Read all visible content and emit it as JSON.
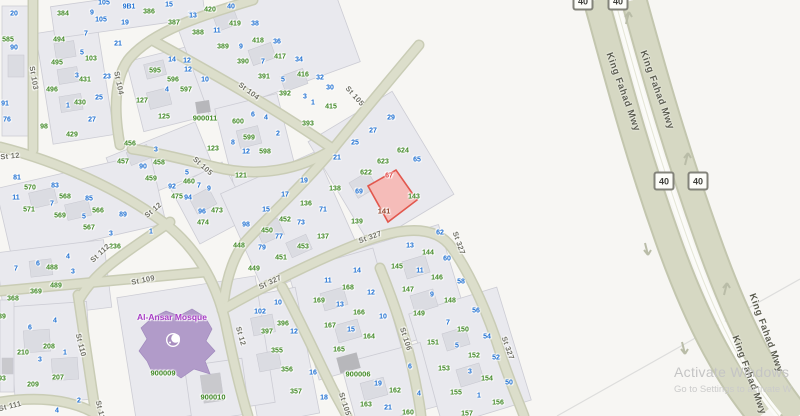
{
  "map": {
    "colors": {
      "lot_number_blue": "#1e6fd1",
      "parcel_number_green": "#3f8724",
      "selected_unit_red": "#e04040",
      "selected_parcel_text": "#8f4026",
      "selected_parcel_fill": "#f5b9b5",
      "selected_parcel_stroke": "#e2574d",
      "road_fill": "#dcdecb",
      "mosque_fill": "#b19bc9",
      "mosque_label": "#a63bc4"
    },
    "selected_parcel": {
      "number": "141",
      "unit_number": "67"
    },
    "mosque": {
      "label": "Al-Ansar Mosque",
      "x": 172,
      "y": 317,
      "parcel_id": "900009"
    },
    "street_labels": [
      {
        "t": "St 103",
        "x": 34,
        "y": 78,
        "r": 80
      },
      {
        "t": "St 104",
        "x": 119,
        "y": 83,
        "r": 78
      },
      {
        "t": "St 104",
        "x": 249,
        "y": 91,
        "r": 37
      },
      {
        "t": "St 105",
        "x": 355,
        "y": 96,
        "r": 48
      },
      {
        "t": "St 105",
        "x": 203,
        "y": 166,
        "r": 42
      },
      {
        "t": "St 105",
        "x": 345,
        "y": 404,
        "r": 72
      },
      {
        "t": "St 12",
        "x": 10,
        "y": 156,
        "r": -6
      },
      {
        "t": "St 12",
        "x": 153,
        "y": 210,
        "r": -40
      },
      {
        "t": "St 12",
        "x": 241,
        "y": 336,
        "r": 74
      },
      {
        "t": "St 112",
        "x": 100,
        "y": 253,
        "r": -43
      },
      {
        "t": "St 109",
        "x": 143,
        "y": 280,
        "r": -12
      },
      {
        "t": "St 110",
        "x": 81,
        "y": 345,
        "r": 76
      },
      {
        "t": "St 110",
        "x": 101,
        "y": 412,
        "r": 76
      },
      {
        "t": "St 111",
        "x": 10,
        "y": 406,
        "r": -14
      },
      {
        "t": "St 106",
        "x": 406,
        "y": 339,
        "r": 72
      },
      {
        "t": "St 327",
        "x": 270,
        "y": 282,
        "r": -25
      },
      {
        "t": "St 327",
        "x": 370,
        "y": 237,
        "r": -20
      },
      {
        "t": "St 327",
        "x": 459,
        "y": 243,
        "r": 70
      },
      {
        "t": "St 327",
        "x": 508,
        "y": 348,
        "r": 70
      }
    ],
    "highway": {
      "name": "King Fahad Mwy",
      "route_number": "40",
      "labels": [
        {
          "x": 623,
          "y": 92,
          "r": 70
        },
        {
          "x": 657,
          "y": 90,
          "r": 70
        },
        {
          "x": 766,
          "y": 333,
          "r": 70
        },
        {
          "x": 749,
          "y": 375,
          "r": 70
        }
      ],
      "shields": [
        {
          "x": 583,
          "y": 1
        },
        {
          "x": 618,
          "y": 1
        },
        {
          "x": 664,
          "y": 181
        },
        {
          "x": 698,
          "y": 181
        }
      ]
    },
    "parcel_labels": [
      [
        "20",
        14,
        14,
        "b"
      ],
      [
        "585",
        8,
        40,
        "g"
      ],
      [
        "90",
        14,
        48,
        "b"
      ],
      [
        "91",
        5,
        104,
        "b"
      ],
      [
        "76",
        7,
        120,
        "b"
      ],
      [
        "98",
        44,
        127,
        "g"
      ],
      [
        "384",
        63,
        14,
        "g"
      ],
      [
        "9",
        92,
        13,
        "b"
      ],
      [
        "105",
        104,
        3,
        "b"
      ],
      [
        "105",
        101,
        20,
        "b"
      ],
      [
        "9B1",
        129,
        7,
        "b"
      ],
      [
        "19",
        125,
        23,
        "b"
      ],
      [
        "386",
        149,
        12,
        "g"
      ],
      [
        "15",
        169,
        5,
        "b"
      ],
      [
        "387",
        174,
        23,
        "g"
      ],
      [
        "13",
        192,
        15,
        "b"
      ],
      [
        "494",
        59,
        40,
        "g"
      ],
      [
        "7",
        86,
        34,
        "b"
      ],
      [
        "5",
        82,
        53,
        "b"
      ],
      [
        "103",
        91,
        59,
        "g"
      ],
      [
        "21",
        118,
        44,
        "b"
      ],
      [
        "495",
        57,
        63,
        "g"
      ],
      [
        "3",
        77,
        76,
        "b"
      ],
      [
        "431",
        85,
        80,
        "g"
      ],
      [
        "23",
        107,
        77,
        "b"
      ],
      [
        "496",
        52,
        90,
        "g"
      ],
      [
        "1",
        68,
        106,
        "b"
      ],
      [
        "430",
        80,
        103,
        "g"
      ],
      [
        "25",
        99,
        98,
        "b"
      ],
      [
        "27",
        92,
        120,
        "b"
      ],
      [
        "429",
        72,
        135,
        "g"
      ],
      [
        "595",
        155,
        71,
        "g"
      ],
      [
        "14",
        172,
        60,
        "b"
      ],
      [
        "12",
        188,
        70,
        "b"
      ],
      [
        "596",
        173,
        80,
        "g"
      ],
      [
        "4",
        167,
        90,
        "b"
      ],
      [
        "597",
        186,
        90,
        "g"
      ],
      [
        "127",
        142,
        101,
        "g"
      ],
      [
        "125",
        164,
        117,
        "g"
      ],
      [
        "388",
        198,
        33,
        "g"
      ],
      [
        "420",
        210,
        10,
        "g"
      ],
      [
        "40",
        231,
        7,
        "b"
      ],
      [
        "13",
        193,
        16,
        "b"
      ],
      [
        "419",
        235,
        24,
        "g"
      ],
      [
        "38",
        255,
        24,
        "b"
      ],
      [
        "11",
        217,
        31,
        "b"
      ],
      [
        "389",
        223,
        47,
        "g"
      ],
      [
        "9",
        241,
        47,
        "b"
      ],
      [
        "418",
        258,
        41,
        "g"
      ],
      [
        "36",
        277,
        42,
        "b"
      ],
      [
        "390",
        243,
        62,
        "g"
      ],
      [
        "7",
        263,
        62,
        "b"
      ],
      [
        "417",
        280,
        57,
        "g"
      ],
      [
        "34",
        299,
        60,
        "b"
      ],
      [
        "391",
        264,
        77,
        "g"
      ],
      [
        "5",
        283,
        80,
        "b"
      ],
      [
        "416",
        303,
        75,
        "g"
      ],
      [
        "32",
        320,
        78,
        "b"
      ],
      [
        "392",
        285,
        94,
        "g"
      ],
      [
        "3",
        305,
        97,
        "b"
      ],
      [
        "30",
        330,
        88,
        "b"
      ],
      [
        "1",
        313,
        103,
        "b"
      ],
      [
        "415",
        331,
        107,
        "g"
      ],
      [
        "393",
        308,
        124,
        "g"
      ],
      [
        "12",
        187,
        61,
        "b"
      ],
      [
        "10",
        205,
        80,
        "b"
      ],
      [
        "900011",
        205,
        118,
        "G"
      ],
      [
        "600",
        238,
        122,
        "g"
      ],
      [
        "6",
        253,
        115,
        "b"
      ],
      [
        "4",
        266,
        118,
        "b"
      ],
      [
        "2",
        278,
        134,
        "b"
      ],
      [
        "599",
        249,
        138,
        "g"
      ],
      [
        "8",
        233,
        143,
        "b"
      ],
      [
        "12",
        246,
        152,
        "b"
      ],
      [
        "598",
        265,
        152,
        "g"
      ],
      [
        "121",
        241,
        176,
        "g"
      ],
      [
        "123",
        213,
        149,
        "g"
      ],
      [
        "29",
        391,
        118,
        "b"
      ],
      [
        "27",
        373,
        131,
        "b"
      ],
      [
        "25",
        355,
        143,
        "b"
      ],
      [
        "21",
        337,
        158,
        "b"
      ],
      [
        "624",
        403,
        151,
        "g"
      ],
      [
        "623",
        383,
        162,
        "g"
      ],
      [
        "622",
        366,
        173,
        "g"
      ],
      [
        "65",
        417,
        160,
        "b"
      ],
      [
        "67",
        389,
        176,
        "r"
      ],
      [
        "138",
        335,
        189,
        "g"
      ],
      [
        "69",
        359,
        192,
        "b"
      ],
      [
        "143",
        414,
        197,
        "g"
      ],
      [
        "141",
        384,
        211,
        "d"
      ],
      [
        "139",
        357,
        222,
        "g"
      ],
      [
        "19",
        304,
        181,
        "b"
      ],
      [
        "17",
        285,
        195,
        "b"
      ],
      [
        "15",
        266,
        210,
        "b"
      ],
      [
        "136",
        306,
        204,
        "g"
      ],
      [
        "71",
        323,
        210,
        "b"
      ],
      [
        "98",
        246,
        225,
        "b"
      ],
      [
        "452",
        285,
        220,
        "g"
      ],
      [
        "73",
        301,
        223,
        "b"
      ],
      [
        "450",
        267,
        231,
        "g"
      ],
      [
        "77",
        279,
        237,
        "b"
      ],
      [
        "137",
        323,
        237,
        "g"
      ],
      [
        "448",
        239,
        246,
        "g"
      ],
      [
        "79",
        262,
        248,
        "b"
      ],
      [
        "453",
        303,
        247,
        "g"
      ],
      [
        "451",
        281,
        258,
        "g"
      ],
      [
        "449",
        254,
        269,
        "g"
      ],
      [
        "456",
        130,
        144,
        "g"
      ],
      [
        "3",
        156,
        150,
        "b"
      ],
      [
        "457",
        123,
        162,
        "g"
      ],
      [
        "90",
        143,
        167,
        "b"
      ],
      [
        "458",
        159,
        163,
        "g"
      ],
      [
        "459",
        151,
        179,
        "g"
      ],
      [
        "5",
        187,
        173,
        "b"
      ],
      [
        "460",
        189,
        182,
        "g"
      ],
      [
        "92",
        172,
        187,
        "b"
      ],
      [
        "475",
        177,
        197,
        "g"
      ],
      [
        "94",
        188,
        198,
        "b"
      ],
      [
        "7",
        199,
        186,
        "b"
      ],
      [
        "9",
        209,
        189,
        "b"
      ],
      [
        "96",
        202,
        212,
        "b"
      ],
      [
        "473",
        217,
        211,
        "g"
      ],
      [
        "474",
        203,
        223,
        "g"
      ],
      [
        "81",
        17,
        178,
        "b"
      ],
      [
        "570",
        30,
        188,
        "g"
      ],
      [
        "83",
        55,
        186,
        "b"
      ],
      [
        "11",
        16,
        198,
        "b"
      ],
      [
        "568",
        65,
        197,
        "g"
      ],
      [
        "85",
        89,
        199,
        "b"
      ],
      [
        "571",
        29,
        210,
        "g"
      ],
      [
        "7",
        52,
        204,
        "b"
      ],
      [
        "569",
        60,
        216,
        "g"
      ],
      [
        "5",
        84,
        217,
        "b"
      ],
      [
        "566",
        98,
        211,
        "g"
      ],
      [
        "567",
        89,
        228,
        "g"
      ],
      [
        "3",
        111,
        234,
        "b"
      ],
      [
        "89",
        123,
        215,
        "b"
      ],
      [
        "1",
        151,
        232,
        "b"
      ],
      [
        "236",
        115,
        247,
        "g"
      ],
      [
        "7",
        16,
        269,
        "b"
      ],
      [
        "6",
        38,
        264,
        "b"
      ],
      [
        "488",
        52,
        268,
        "g"
      ],
      [
        "4",
        68,
        257,
        "b"
      ],
      [
        "3",
        73,
        272,
        "b"
      ],
      [
        "489",
        56,
        286,
        "g"
      ],
      [
        "369",
        36,
        292,
        "g"
      ],
      [
        "368",
        13,
        299,
        "g"
      ],
      [
        "39",
        2,
        317,
        "g"
      ],
      [
        "6",
        30,
        328,
        "b"
      ],
      [
        "4",
        55,
        321,
        "b"
      ],
      [
        "210",
        23,
        353,
        "g"
      ],
      [
        "208",
        49,
        347,
        "g"
      ],
      [
        "3",
        40,
        360,
        "b"
      ],
      [
        "1",
        65,
        353,
        "b"
      ],
      [
        "209",
        33,
        385,
        "g"
      ],
      [
        "207",
        58,
        378,
        "g"
      ],
      [
        "93",
        2,
        379,
        "g"
      ],
      [
        "2",
        79,
        401,
        "b"
      ],
      [
        "4",
        57,
        411,
        "b"
      ],
      [
        "900009",
        163,
        373,
        "G"
      ],
      [
        "900010",
        213,
        397,
        "G"
      ],
      [
        "10",
        278,
        303,
        "b"
      ],
      [
        "102",
        260,
        312,
        "b"
      ],
      [
        "396",
        283,
        324,
        "g"
      ],
      [
        "397",
        267,
        332,
        "g"
      ],
      [
        "12",
        294,
        332,
        "b"
      ],
      [
        "355",
        277,
        351,
        "g"
      ],
      [
        "356",
        287,
        370,
        "g"
      ],
      [
        "16",
        313,
        373,
        "b"
      ],
      [
        "357",
        296,
        392,
        "g"
      ],
      [
        "18",
        324,
        398,
        "b"
      ],
      [
        "14",
        357,
        271,
        "b"
      ],
      [
        "11",
        328,
        281,
        "b"
      ],
      [
        "168",
        348,
        288,
        "g"
      ],
      [
        "12",
        371,
        293,
        "b"
      ],
      [
        "169",
        319,
        301,
        "g"
      ],
      [
        "13",
        340,
        305,
        "b"
      ],
      [
        "166",
        359,
        313,
        "g"
      ],
      [
        "10",
        383,
        317,
        "b"
      ],
      [
        "167",
        330,
        326,
        "g"
      ],
      [
        "15",
        351,
        330,
        "b"
      ],
      [
        "164",
        369,
        337,
        "g"
      ],
      [
        "165",
        339,
        350,
        "g"
      ],
      [
        "900006",
        358,
        374,
        "G"
      ],
      [
        "6",
        410,
        367,
        "b"
      ],
      [
        "19",
        378,
        384,
        "b"
      ],
      [
        "162",
        395,
        391,
        "g"
      ],
      [
        "4",
        419,
        394,
        "b"
      ],
      [
        "163",
        366,
        405,
        "g"
      ],
      [
        "21",
        388,
        408,
        "b"
      ],
      [
        "160",
        408,
        413,
        "g"
      ],
      [
        "62",
        440,
        233,
        "b"
      ],
      [
        "13",
        410,
        246,
        "b"
      ],
      [
        "144",
        428,
        253,
        "g"
      ],
      [
        "60",
        447,
        259,
        "b"
      ],
      [
        "145",
        397,
        267,
        "g"
      ],
      [
        "11",
        420,
        271,
        "b"
      ],
      [
        "146",
        437,
        278,
        "g"
      ],
      [
        "58",
        461,
        282,
        "b"
      ],
      [
        "147",
        408,
        290,
        "g"
      ],
      [
        "9",
        432,
        295,
        "b"
      ],
      [
        "148",
        450,
        301,
        "g"
      ],
      [
        "149",
        419,
        314,
        "g"
      ],
      [
        "56",
        476,
        311,
        "b"
      ],
      [
        "7",
        448,
        323,
        "b"
      ],
      [
        "150",
        463,
        330,
        "g"
      ],
      [
        "54",
        487,
        337,
        "b"
      ],
      [
        "151",
        433,
        343,
        "g"
      ],
      [
        "5",
        457,
        346,
        "b"
      ],
      [
        "152",
        474,
        356,
        "g"
      ],
      [
        "52",
        496,
        358,
        "b"
      ],
      [
        "153",
        444,
        369,
        "g"
      ],
      [
        "3",
        470,
        372,
        "b"
      ],
      [
        "154",
        487,
        379,
        "g"
      ],
      [
        "50",
        509,
        383,
        "b"
      ],
      [
        "155",
        456,
        393,
        "g"
      ],
      [
        "1",
        479,
        396,
        "b"
      ],
      [
        "156",
        498,
        403,
        "g"
      ],
      [
        "157",
        467,
        414,
        "g"
      ]
    ]
  },
  "watermark": {
    "line1": "Activate Windows",
    "line2": "Go to Settings to activate W"
  }
}
